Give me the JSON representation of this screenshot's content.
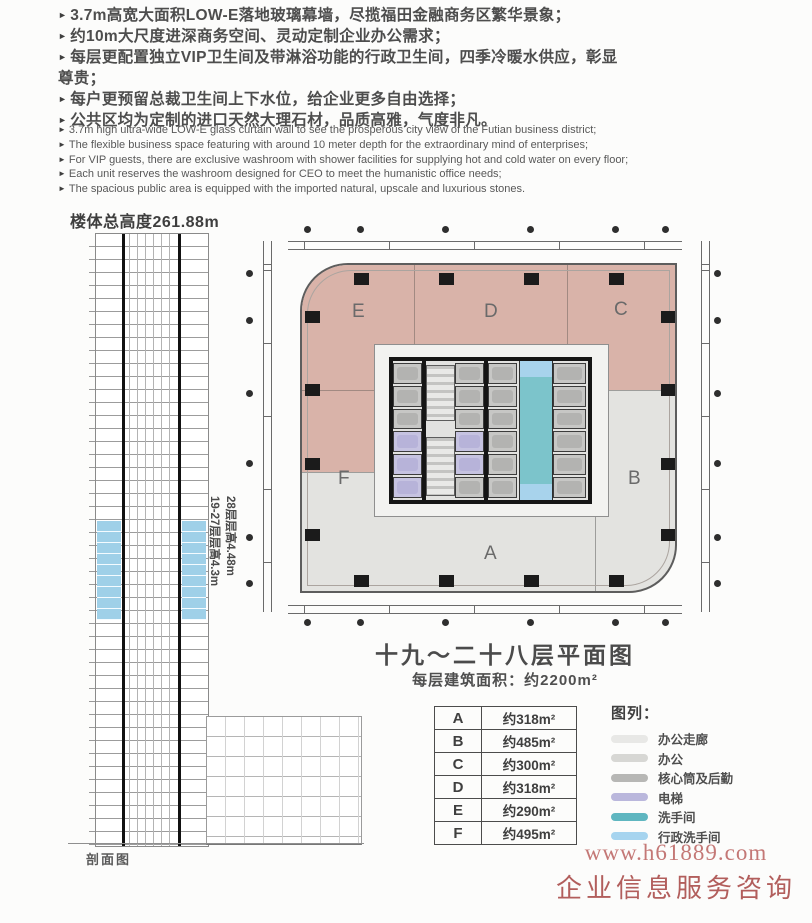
{
  "icons": {
    "bullet_arrow": "►"
  },
  "features_cn": [
    "3.7m高宽大面积LOW-E落地玻璃幕墙，尽揽福田金融商务区繁华景象；",
    "约10m大尺度进深商务空间、灵动定制企业办公需求；",
    "每层更配置独立VIP卫生间及带淋浴功能的行政卫生间，四季冷暖水供应，彰显尊贵；",
    "每户更预留总裁卫生间上下水位，给企业更多自由选择；",
    "公共区均为定制的进口天然大理石材，品质高雅，气度非凡。"
  ],
  "features_en": [
    "3.7m high ultra-wide LOW-E glass curtain wall to see the prosperous city view of the Futian business district;",
    "The flexible business space featuring with around 10 meter depth for the extraordinary mind of enterprises;",
    "For VIP guests, there are exclusive washroom with shower facilities for supplying hot and cold water on every floor;",
    "Each unit reserves the washroom designed for CEO to meet the humanistic office needs;",
    "The spacious public area is equipped with the imported natural, upscale and luxurious stones."
  ],
  "section": {
    "height_label": "楼体总高度261.88m",
    "floor_label_28": "28层层高4.48m",
    "floor_label_19_27": "19-27层层高4.3m",
    "caption": "剖面图"
  },
  "plan": {
    "title": "十九～二十八层平面图",
    "area_note": "每层建筑面积：约2200m²",
    "zones": {
      "E": "E",
      "D": "D",
      "C": "C",
      "F": "F",
      "B": "B",
      "A": "A"
    }
  },
  "area_table": {
    "rows": [
      {
        "zone": "A",
        "area": "约318m²"
      },
      {
        "zone": "B",
        "area": "约485m²"
      },
      {
        "zone": "C",
        "area": "约300m²"
      },
      {
        "zone": "D",
        "area": "约318m²"
      },
      {
        "zone": "E",
        "area": "约290m²"
      },
      {
        "zone": "F",
        "area": "约495m²"
      }
    ]
  },
  "legend": {
    "title": "图列：",
    "items": [
      {
        "label": "办公走廊",
        "color": "#e8e8e6"
      },
      {
        "label": "办公",
        "color": "#d7d7d4"
      },
      {
        "label": "核心筒及后勤",
        "color": "#b7b7b5"
      },
      {
        "label": "电梯",
        "color": "#bab7dc"
      },
      {
        "label": "洗手间",
        "color": "#5fb6c0"
      },
      {
        "label": "行政洗手间",
        "color": "#a6d4ef"
      }
    ]
  },
  "watermark": {
    "url": "www.h61889.com",
    "caption": "企业信息服务咨询"
  },
  "colors": {
    "zone_pink": "#d9b3a9",
    "zone_gray": "#e3e3e0",
    "washroom_teal": "#7cc4cb",
    "exec_washroom_blue": "#a8d3ec",
    "elevator_purple": "#c6c3e1",
    "section_highlight_blue": "#9fd0e8",
    "watermark_red": "#b25e5c"
  }
}
